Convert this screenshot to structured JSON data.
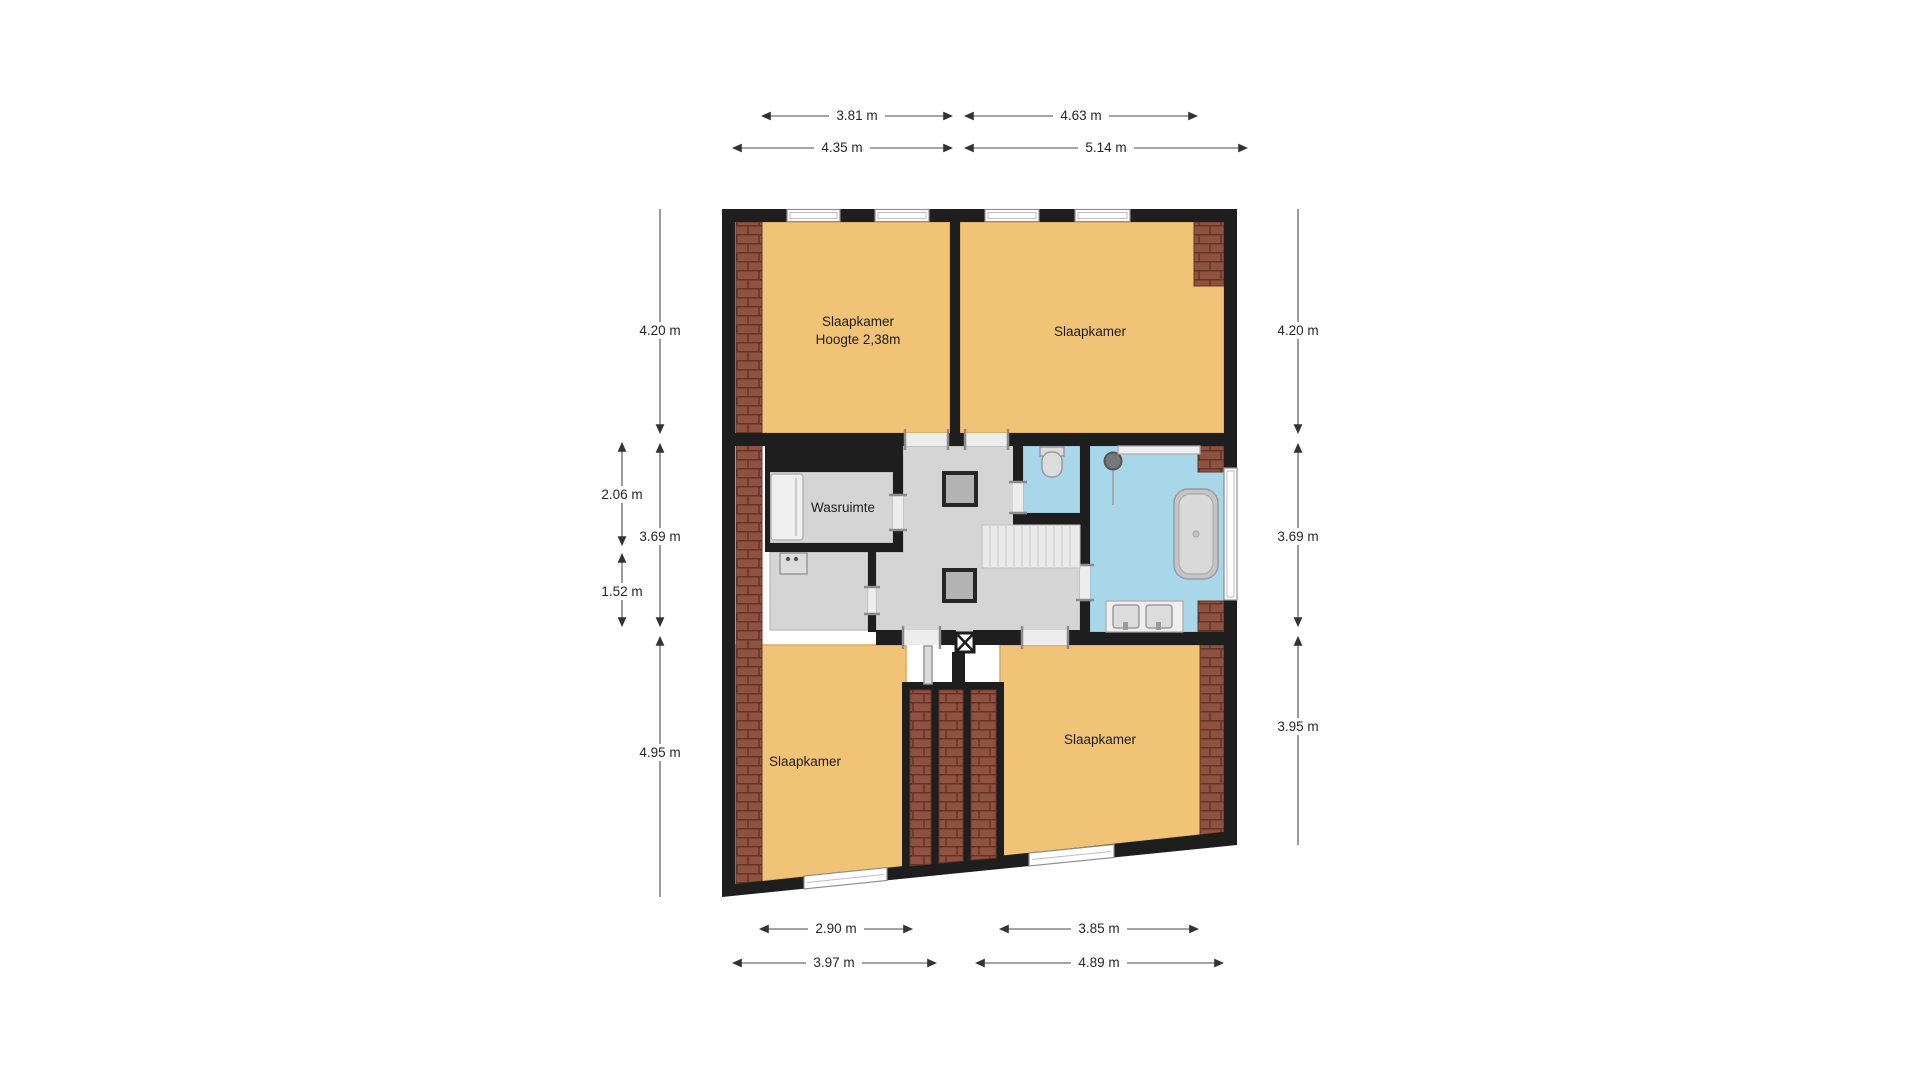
{
  "plan": {
    "type": "floor-plan",
    "language": "Dutch",
    "rooms": {
      "bedroom_top_left": {
        "label": "Slaapkamer",
        "sublabel": "Hoogte 2,38m"
      },
      "bedroom_top_right": {
        "label": "Slaapkamer"
      },
      "laundry": {
        "label": "Wasruimte"
      },
      "bedroom_bottom_left": {
        "label": "Slaapkamer"
      },
      "bedroom_bottom_right": {
        "label": "Slaapkamer"
      }
    },
    "fixtures": [
      "bathtub",
      "shower-head",
      "double-sink-vanity",
      "toilet",
      "staircase",
      "skylight",
      "skylight",
      "wardrobe",
      "washing-machine",
      "chimney-shaft",
      "door-leaf"
    ],
    "dimensions": {
      "top": [
        {
          "label": "3.81 m"
        },
        {
          "label": "4.63 m"
        },
        {
          "label": "4.35 m"
        },
        {
          "label": "5.14 m"
        }
      ],
      "left": [
        {
          "label": "4.20 m"
        },
        {
          "label": "2.06 m"
        },
        {
          "label": "3.69 m"
        },
        {
          "label": "1.52 m"
        },
        {
          "label": "4.95 m"
        }
      ],
      "right": [
        {
          "label": "4.20 m"
        },
        {
          "label": "3.69 m"
        },
        {
          "label": "3.95 m"
        }
      ],
      "bottom": [
        {
          "label": "2.90 m"
        },
        {
          "label": "3.85 m"
        },
        {
          "label": "3.97 m"
        },
        {
          "label": "4.89 m"
        }
      ]
    }
  },
  "colors": {
    "wall": "#1e1e1e",
    "room": "#F1C377",
    "room-edge": "#DCA95F",
    "floor": "#D5D5D5",
    "floor-edge": "#b9b9b9",
    "wet": "#A9D7EA",
    "wet-edge": "#8FC3DC",
    "brick": "#8F5140",
    "brick-line": "#643527"
  }
}
